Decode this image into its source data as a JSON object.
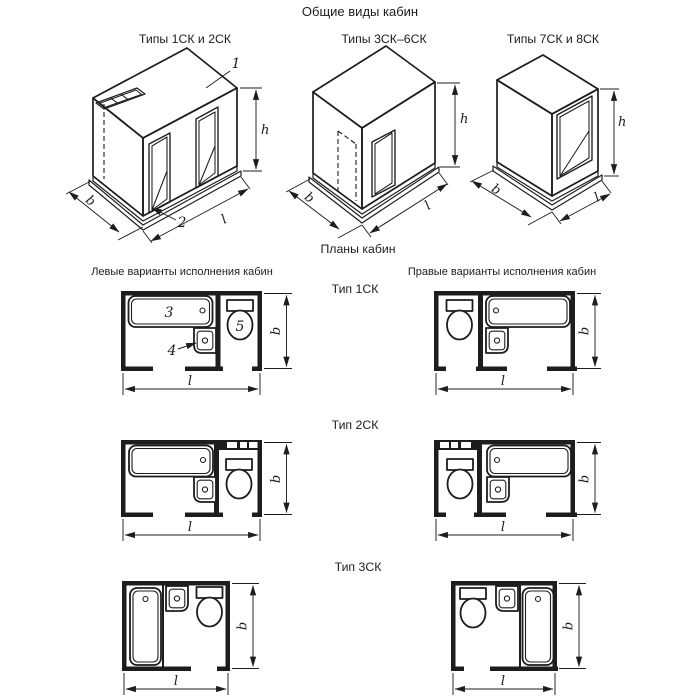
{
  "page": {
    "title": "Общие виды кабин",
    "plans_title": "Планы кабин"
  },
  "views": [
    {
      "label": "Типы 1СК и 2СК"
    },
    {
      "label": "Типы 3СК–6СК"
    },
    {
      "label": "Типы 7СК и 8СК"
    }
  ],
  "plans": {
    "left_header": "Левые варианты исполнения кабин",
    "right_header": "Правые варианты исполнения кабин",
    "types": [
      {
        "label": "Тип 1СК"
      },
      {
        "label": "Тип 2СК"
      },
      {
        "label": "Тип 3СК"
      }
    ]
  },
  "dimensions": {
    "height": "h",
    "width": "b",
    "length": "l"
  },
  "callouts": {
    "ceiling_panel": "1",
    "floor_panel": "2",
    "bathtub": "3",
    "washbasin": "4",
    "toilet": "5"
  },
  "colors": {
    "ink": "#1d1d1d",
    "background": "#ffffff"
  }
}
